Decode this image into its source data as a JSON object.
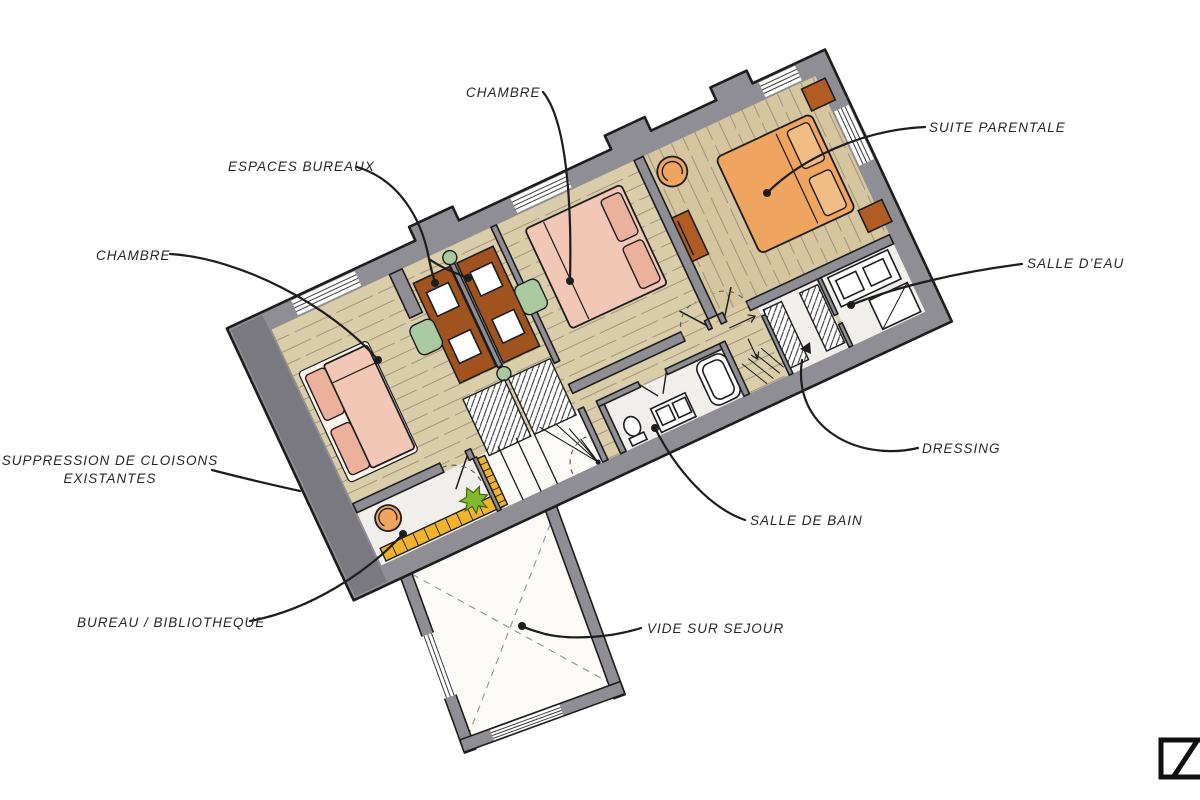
{
  "palette": {
    "wall_gray": "#8f8e94",
    "wall_dark": "#7a7980",
    "wood": "#d9cdaa",
    "wood_suite": "#d5c6a0",
    "white_room": "#f1efeb",
    "bed_pink": "#f2c7b6",
    "bed_orange": "#efa45f",
    "furn_brown": "#a0521f",
    "chair_green": "#a9c9a1",
    "shelf_yellow": "#f0b42c",
    "plant_green": "#82b82e",
    "ink": "#1d1d1d"
  },
  "labels": {
    "chambre_top": "CHAMBRE",
    "suite_parentale": "SUITE PARENTALE",
    "espaces_bureaux": "ESPACES BUREAUX",
    "chambre_left": "CHAMBRE",
    "salle_deau": "SALLE D’EAU",
    "suppression_line1": "SUPPRESSION DE CLOISONS",
    "suppression_line2": "EXISTANTES",
    "dressing": "DRESSING",
    "salle_de_bain": "SALLE DE BAIN",
    "bureau_bibliotheque": "BUREAU / BIBLIOTHEQUE",
    "vide_sur_sejour": "VIDE SUR SEJOUR"
  },
  "logo": {
    "mark": "Z"
  }
}
